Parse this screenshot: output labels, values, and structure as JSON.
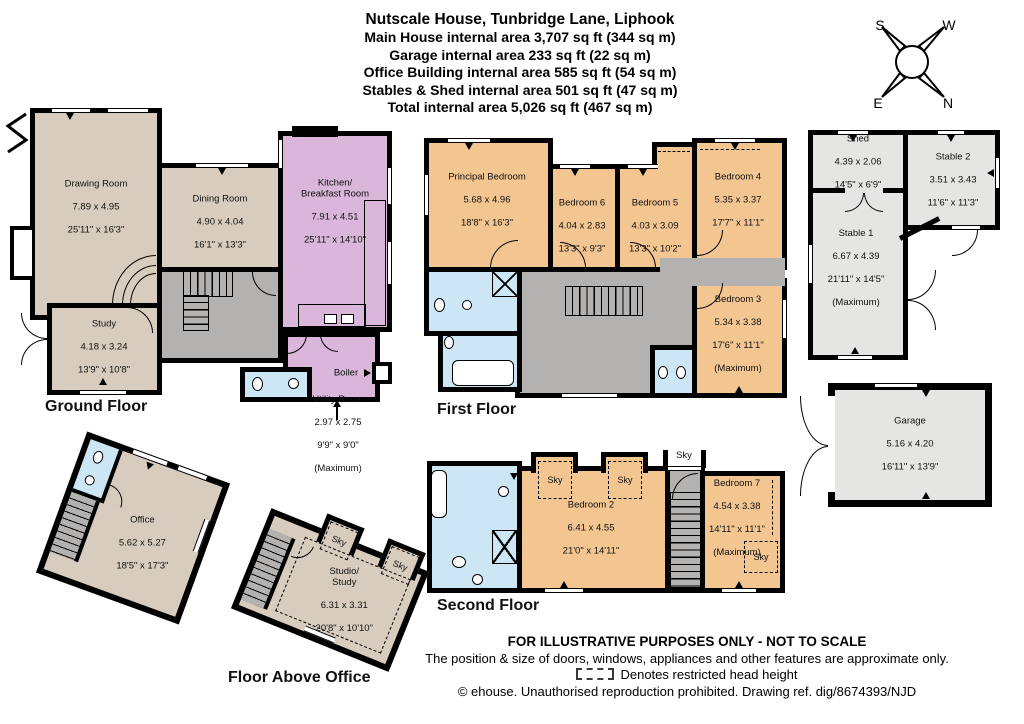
{
  "header": {
    "title": "Nutscale House, Tunbridge Lane, Liphook",
    "area_lines": [
      "Main House internal area 3,707 sq ft (344 sq m)",
      "Garage internal area 233 sq ft (22 sq m)",
      "Office Building internal area 585 sq ft (54 sq m)",
      "Stables & Shed internal area 501 sq ft (47 sq m)",
      "Total internal area 5,026 sq ft (467 sq m)"
    ]
  },
  "compass": {
    "n": "N",
    "s": "S",
    "e": "E",
    "w": "W"
  },
  "labels": {
    "sky": "Sky",
    "boiler": "Boiler"
  },
  "floors": {
    "ground": {
      "label": "Ground Floor",
      "rooms": {
        "drawing": {
          "name": "Drawing Room",
          "metric": "7.89 x 4.95",
          "imperial": "25'11\" x 16'3\""
        },
        "dining": {
          "name": "Dining Room",
          "metric": "4.90 x 4.04",
          "imperial": "16'1\" x 13'3\""
        },
        "kitchen": {
          "name": "Kitchen/\nBreakfast Room",
          "metric": "7.91 x 4.51",
          "imperial": "25'11\" x 14'10\""
        },
        "study": {
          "name": "Study",
          "metric": "4.18 x 3.24",
          "imperial": "13'9\" x 10'8\""
        },
        "utility": {
          "name": "Utility Room",
          "metric": "2.97 x 2.75",
          "imperial": "9'9\" x 9'0\"",
          "note": "(Maximum)"
        }
      }
    },
    "first": {
      "label": "First Floor",
      "rooms": {
        "principal": {
          "name": "Principal Bedroom",
          "metric": "5.68 x 4.96",
          "imperial": "18'8\" x 16'3\""
        },
        "bed6": {
          "name": "Bedroom 6",
          "metric": "4.04 x 2.83",
          "imperial": "13'3\" x 9'3\""
        },
        "bed5": {
          "name": "Bedroom 5",
          "metric": "4.03 x 3.09",
          "imperial": "13'3\" x 10'2\""
        },
        "bed4": {
          "name": "Bedroom 4",
          "metric": "5.35 x 3.37",
          "imperial": "17'7\" x 11'1\""
        },
        "bed3": {
          "name": "Bedroom 3",
          "metric": "5.34 x 3.38",
          "imperial": "17'6\" x 11'1\"",
          "note": "(Maximum)"
        }
      }
    },
    "second": {
      "label": "Second Floor",
      "rooms": {
        "bed2": {
          "name": "Bedroom 2",
          "metric": "6.41 x 4.55",
          "imperial": "21'0\" x 14'11\""
        },
        "bed7": {
          "name": "Bedroom 7",
          "metric": "4.54 x 3.38",
          "imperial": "14'11\" x 11'1\"",
          "note": "(Maximum)"
        }
      }
    },
    "stables": {
      "rooms": {
        "shed": {
          "name": "Shed",
          "metric": "4.39 x 2.06",
          "imperial": "14'5\" x 6'9\""
        },
        "stable2": {
          "name": "Stable 2",
          "metric": "3.51 x 3.43",
          "imperial": "11'6\" x 11'3\""
        },
        "stable1": {
          "name": "Stable 1",
          "metric": "6.67 x 4.39",
          "imperial": "21'11\" x 14'5\"",
          "note": "(Maximum)"
        }
      }
    },
    "garage": {
      "rooms": {
        "garage": {
          "name": "Garage",
          "metric": "5.16 x 4.20",
          "imperial": "16'11\" x 13'9\""
        }
      }
    },
    "office": {
      "rooms": {
        "office": {
          "name": "Office",
          "metric": "5.62 x 5.27",
          "imperial": "18'5\" x 17'3\""
        }
      }
    },
    "above_office": {
      "label": "Floor Above Office",
      "rooms": {
        "studio": {
          "name": "Studio/\nStudy",
          "metric": "6.31 x 3.31",
          "imperial": "20'8\" x 10'10\""
        }
      }
    }
  },
  "footer": {
    "line1": "FOR ILLUSTRATIVE PURPOSES ONLY - NOT TO SCALE",
    "line2": "The position & size of doors, windows, appliances and other features are approximate only.",
    "line3": "Denotes restricted head height",
    "line4": "© ehouse. Unauthorised reproduction prohibited. Drawing ref. dig/8674393/NJD"
  },
  "colors": {
    "wall": "#000000",
    "reception_beige": "#d8ccbf",
    "kitchen_purple": "#d9b6da",
    "hall_gray": "#b4b1b1",
    "bathroom_blue": "#cde6f5",
    "bedroom_orange": "#f3c591",
    "outbuilding_gray": "#e5e5e4"
  }
}
